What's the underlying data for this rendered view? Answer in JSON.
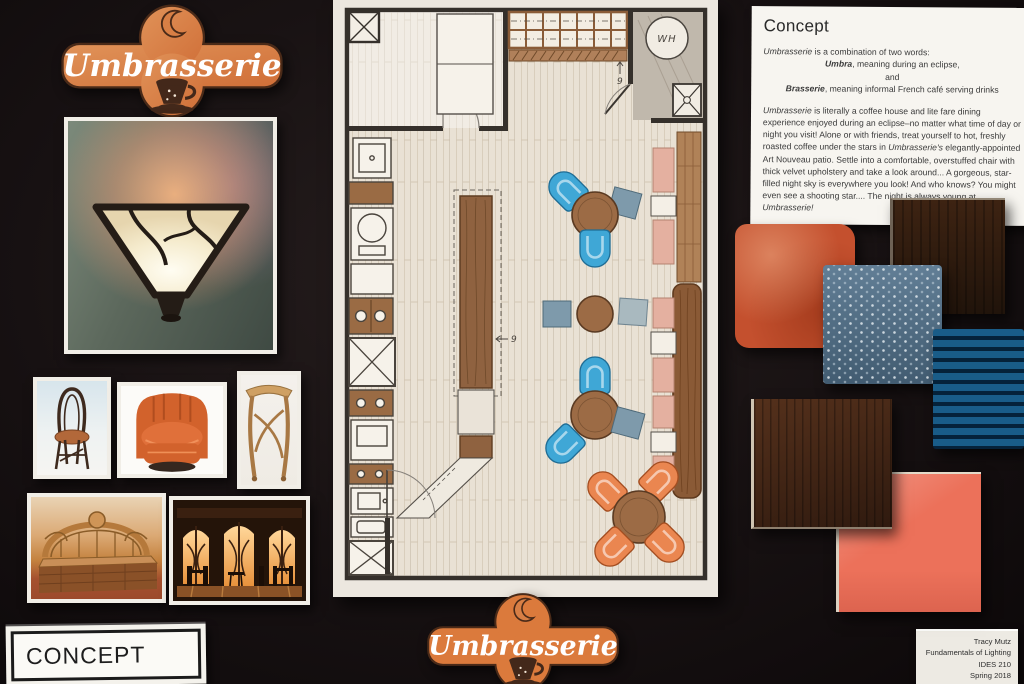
{
  "board": {
    "bg_color": "#171112"
  },
  "logo": {
    "text": "Umbrasserie",
    "badge_color": "#d9803f",
    "outline_color": "#4a2a18",
    "icons": [
      "crescent-moon-icon",
      "coffee-cup-icon"
    ]
  },
  "concept_card": {
    "title": "Concept",
    "intro": [
      {
        "em": "Umbrasserie",
        "rest": " is a combination of two words:"
      },
      {
        "em": "Umbra",
        "rest": ", meaning during an eclipse,"
      },
      {
        "em": "",
        "rest": "and"
      },
      {
        "em": "Brasserie",
        "rest": ", meaning informal French café serving drinks"
      }
    ],
    "body_segments": [
      {
        "em": true,
        "text": "Umbrasserie"
      },
      {
        "em": false,
        "text": " is literally a coffee house and lite fare dining experience enjoyed during an eclipse–no matter what time of day or night you visit!  Alone or with friends, treat yourself to hot, freshly roasted coffee under the stars in "
      },
      {
        "em": true,
        "text": "Umbrasserie's"
      },
      {
        "em": false,
        "text": " elegantly-appointed Art Nouveau patio.  Settle into a comfortable, overstuffed chair with thick velvet upholstery and take a look around...  A gorgeous, star-filled night sky is everywhere you look!  And who knows?  You might even see a shooting star....  The night is always young at "
      },
      {
        "em": true,
        "text": "Umbrasserie!"
      }
    ]
  },
  "floor_plan": {
    "water_heater_label": "WH",
    "note": "9"
  },
  "materials": [
    {
      "name": "orange-velvet-swatch",
      "color": "#c4502e"
    },
    {
      "name": "espresso-wood-panel",
      "color": "#2b1a0e"
    },
    {
      "name": "blue-dotted-upholstery-swatch",
      "color": "#50708a"
    },
    {
      "name": "teal-ribbed-velvet-swatch",
      "color": "#0d466b"
    },
    {
      "name": "walnut-wood-panel",
      "color": "#3f2415"
    },
    {
      "name": "coral-glass-tile",
      "color": "#ec715a"
    }
  ],
  "inspiration_images": [
    "wall-sconce-photo",
    "art-nouveau-side-chair-photo",
    "orange-club-chair-photo",
    "art-nouveau-console-table-photo",
    "art-nouveau-bar-photo",
    "art-nouveau-cafe-interior-photo"
  ],
  "concept_label": {
    "text": "CONCEPT"
  },
  "credit_card": {
    "lines": [
      "Tracy Mutz",
      "Fundamentals of Lighting",
      "IDES 210",
      "Spring 2018"
    ]
  }
}
